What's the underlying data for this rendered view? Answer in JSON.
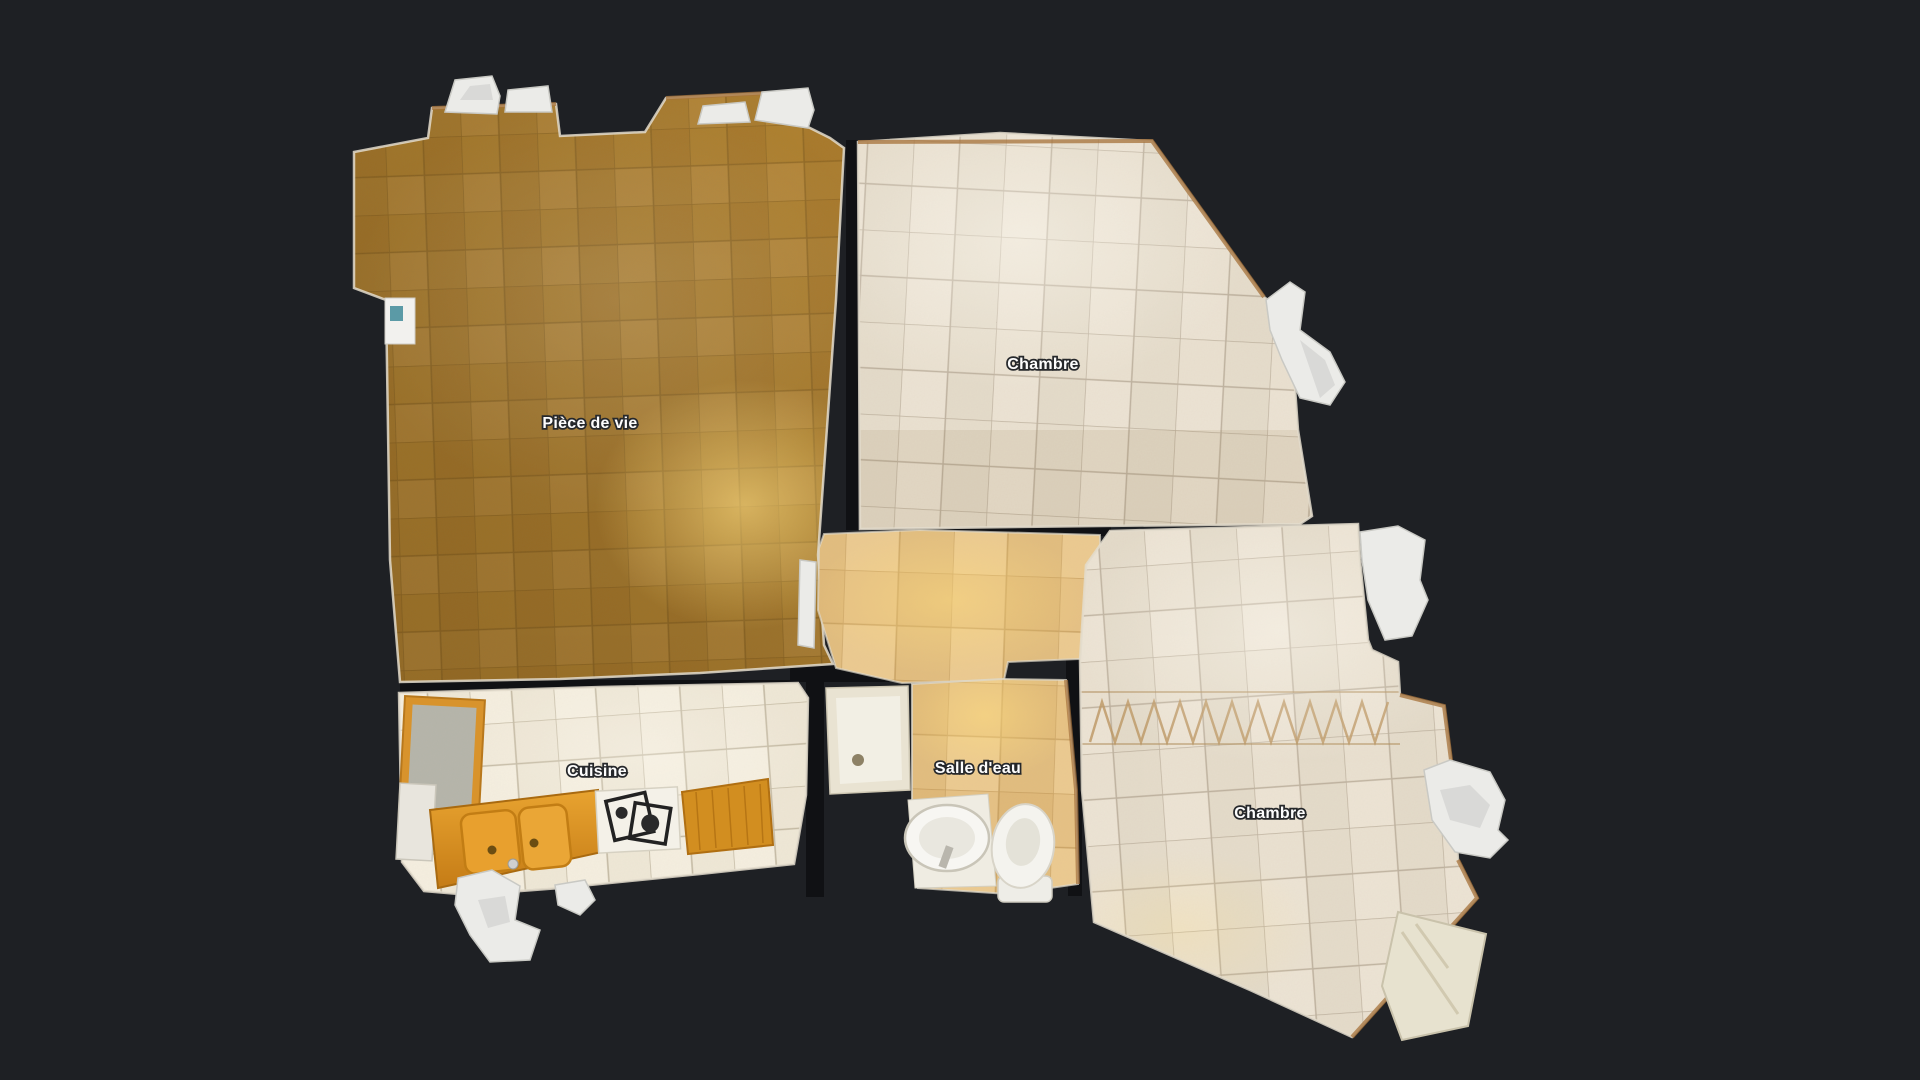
{
  "scene": {
    "type": "dollhouse-floorplan-top-view",
    "background_color": "#1e2024",
    "wall_gap_color": "#101114",
    "wall_rim_color": "#e3dccd",
    "wall_top_color": "#a5713a"
  },
  "rooms": [
    {
      "id": "piece-de-vie",
      "label": "Pièce de vie",
      "floor": "carpet-orange",
      "floor_color": "#b5842f"
    },
    {
      "id": "chambre-nord",
      "label": "Chambre",
      "floor": "tile-beige",
      "floor_color": "#e8dfcf"
    },
    {
      "id": "couloir",
      "label": "",
      "floor": "tile-tan",
      "floor_color": "#e4bf81"
    },
    {
      "id": "cuisine",
      "label": "Cuisine",
      "floor": "tile-white",
      "floor_color": "#f1e9d9"
    },
    {
      "id": "salle-d-eau",
      "label": "Salle d'eau",
      "floor": "tile-tan",
      "floor_color": "#e4bf81"
    },
    {
      "id": "chambre-sud",
      "label": "Chambre",
      "floor": "tile-beige",
      "floor_color": "#e8dfcf"
    }
  ],
  "fixtures": [
    {
      "name": "fridge"
    },
    {
      "name": "kitchen-double-sink"
    },
    {
      "name": "kitchen-hob"
    },
    {
      "name": "kitchen-worktop"
    },
    {
      "name": "shower-tray"
    },
    {
      "name": "washbasin"
    },
    {
      "name": "toilet"
    },
    {
      "name": "door-leaf"
    },
    {
      "name": "window-sill"
    },
    {
      "name": "scan-artifact-blob"
    }
  ]
}
